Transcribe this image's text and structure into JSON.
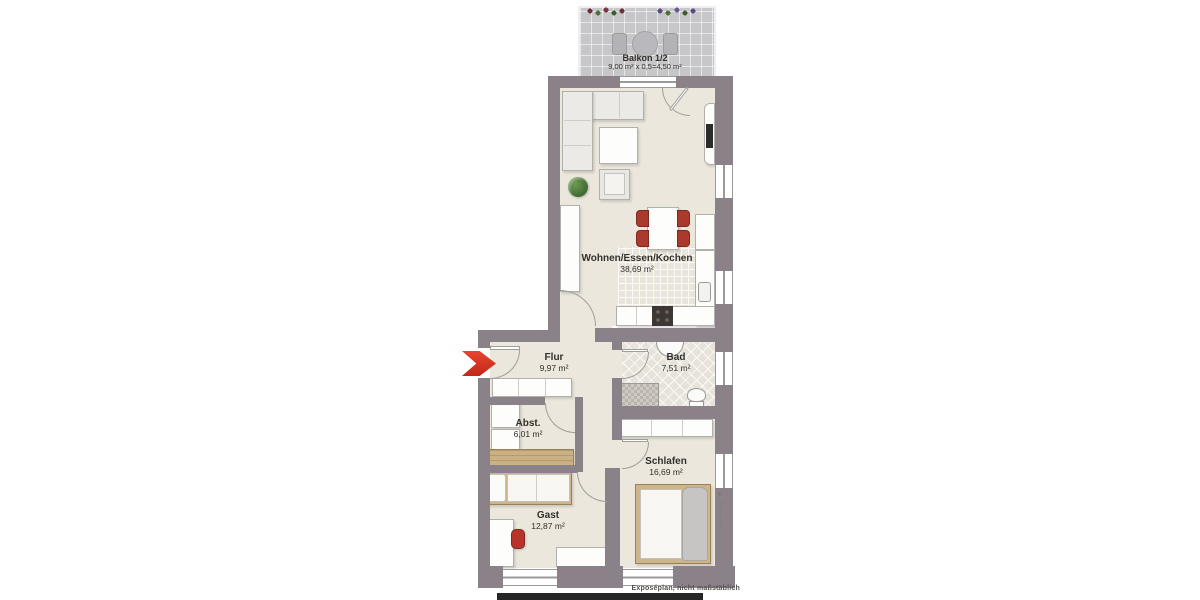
{
  "plan": {
    "type": "apartment-floorplan",
    "rooms": [
      {
        "name": "Balkon 1/2",
        "area": "9,00 m² x 0,5=4,50 m²"
      },
      {
        "name": "Wohnen/Essen/Kochen",
        "area": "38,69 m²"
      },
      {
        "name": "Flur",
        "area": "9,97 m²"
      },
      {
        "name": "Bad",
        "area": "7,51 m²"
      },
      {
        "name": "Abst.",
        "area": "6,01 m²"
      },
      {
        "name": "Gast",
        "area": "12,87 m²"
      },
      {
        "name": "Schlafen",
        "area": "16,69 m²"
      }
    ]
  },
  "annotations": {
    "footer_note": "Exposéplan, nicht maßstäblich",
    "side_watermark": "© ‧‧‧‧‧‧‧‧‧‧‧‧‧"
  },
  "colors": {
    "wall": "#8b8289",
    "floor": "#ebe7dd",
    "balcony_floor": "#c7c7ca",
    "entry_arrow_red": "#e03122",
    "dining_chair_red": "#a93a2c",
    "wood": "#c9b183",
    "blanket_gray": "#c6c5c3"
  },
  "icons": [
    "entry-arrow",
    "flower-box",
    "balcony-table",
    "balcony-chair",
    "corner-sofa",
    "coffee-table",
    "armchair",
    "plant",
    "tv-panel",
    "wall-shelf",
    "dining-table",
    "dining-chair",
    "kitchen-counter",
    "stove",
    "kitchen-sink",
    "tall-cabinet",
    "bath-sink",
    "toilet",
    "shower",
    "door-swing",
    "window",
    "hall-wardrobe",
    "storage-shelf",
    "wood-sideboard",
    "single-bed",
    "desk",
    "desk-chair",
    "lowboard",
    "wardrobe",
    "double-bed",
    "scale-bar"
  ]
}
